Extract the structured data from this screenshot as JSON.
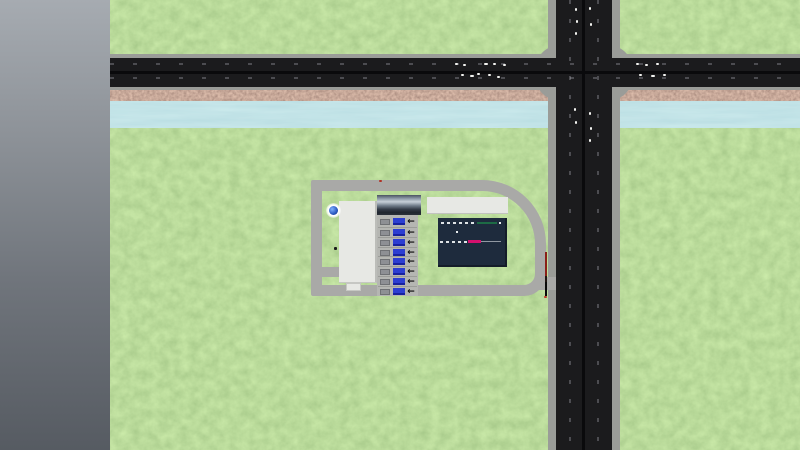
{
  "scene": {
    "description": "top-down transport simulation map view with river, road intersection and truck logistics facility",
    "viewport": {
      "width": 800,
      "height": 450
    },
    "visible_text": "none"
  },
  "colors": {
    "grass_base": "#7cb356",
    "river_blue": "#85c4cd",
    "rock_brown": "#7a4a41",
    "asphalt": "#1b1b1d",
    "road_center": "#0a0a0c",
    "curb": "#9a9c98",
    "complex_road": "#a9a9a7",
    "building_white": "#e7e8e4",
    "dock_concrete": "#b5b6b2",
    "navy_building": "#1e2b3d",
    "truck_blue": "#2c3ed2",
    "bay_box": "#8e9094",
    "marking_green": "#1d6b45",
    "marking_magenta": "#d4106e",
    "pole_red": "#8a2018",
    "vehicle_white": "#f2f3f0"
  },
  "terrain": {
    "void_panel": "out-of-map gray gradient band, left 110px",
    "river": {
      "y": 101,
      "height": 27
    },
    "rock_embankment": {
      "y": 88,
      "height": 15
    }
  },
  "roads": {
    "horizontal_road": {
      "lanes": 2,
      "y": 58,
      "height": 29
    },
    "vertical_road": {
      "lanes": 2,
      "x": 556,
      "width": 56
    },
    "intersection": {
      "x": 536,
      "y": 46,
      "width": 96,
      "height": 54
    }
  },
  "facility": {
    "ring_road": "loop road around industrial plot with large top-right curve",
    "warehouse": "large white building, west side",
    "office": "white strip building, north-east",
    "factory": "dark navy flat roof with white/green/magenta pipe markings",
    "dock": {
      "rows": 8,
      "arrow_icon": "←",
      "truck_color_note": "blue trailers at each bay"
    },
    "fountain": "blue pool with white splash on lawn",
    "barrier_pole": "red/black gate pole at east entrance"
  },
  "vehicles": [
    {
      "name": "vehicle-dot",
      "x": 455,
      "y": 63,
      "w": 3,
      "h": 2,
      "color": "#f2f3f0"
    },
    {
      "name": "vehicle-dot",
      "x": 463,
      "y": 64,
      "w": 3,
      "h": 2,
      "color": "#f2f3f0"
    },
    {
      "name": "vehicle-dot",
      "x": 484,
      "y": 63,
      "w": 4,
      "h": 2,
      "color": "#f2f3f0"
    },
    {
      "name": "vehicle-dot",
      "x": 493,
      "y": 63,
      "w": 3,
      "h": 2,
      "color": "#f2f3f0"
    },
    {
      "name": "vehicle-dot",
      "x": 503,
      "y": 64,
      "w": 3,
      "h": 2,
      "color": "#f2f3f0"
    },
    {
      "name": "vehicle-dot",
      "x": 461,
      "y": 74,
      "w": 3,
      "h": 2,
      "color": "#f2f3f0"
    },
    {
      "name": "vehicle-dot",
      "x": 470,
      "y": 75,
      "w": 4,
      "h": 2,
      "color": "#f2f3f0"
    },
    {
      "name": "vehicle-dot",
      "x": 477,
      "y": 73,
      "w": 3,
      "h": 2,
      "color": "#f2f3f0"
    },
    {
      "name": "vehicle-dot",
      "x": 488,
      "y": 74,
      "w": 3,
      "h": 2,
      "color": "#f2f3f0"
    },
    {
      "name": "vehicle-dot",
      "x": 497,
      "y": 76,
      "w": 3,
      "h": 2,
      "color": "#f2f3f0"
    },
    {
      "name": "vehicle-dot",
      "x": 636,
      "y": 63,
      "w": 3,
      "h": 2,
      "color": "#f2f3f0"
    },
    {
      "name": "vehicle-dot",
      "x": 645,
      "y": 64,
      "w": 3,
      "h": 2,
      "color": "#f2f3f0"
    },
    {
      "name": "vehicle-dot",
      "x": 656,
      "y": 63,
      "w": 3,
      "h": 2,
      "color": "#f2f3f0"
    },
    {
      "name": "vehicle-dot",
      "x": 639,
      "y": 74,
      "w": 3,
      "h": 2,
      "color": "#f2f3f0"
    },
    {
      "name": "vehicle-dot",
      "x": 651,
      "y": 75,
      "w": 4,
      "h": 2,
      "color": "#f2f3f0"
    },
    {
      "name": "vehicle-dot",
      "x": 663,
      "y": 74,
      "w": 3,
      "h": 2,
      "color": "#f2f3f0"
    },
    {
      "name": "vehicle-dot",
      "x": 575,
      "y": 8,
      "w": 2,
      "h": 3,
      "color": "#f2f3f0"
    },
    {
      "name": "vehicle-dot",
      "x": 576,
      "y": 20,
      "w": 2,
      "h": 3,
      "color": "#f2f3f0"
    },
    {
      "name": "vehicle-dot",
      "x": 575,
      "y": 32,
      "w": 2,
      "h": 3,
      "color": "#f2f3f0"
    },
    {
      "name": "vehicle-dot",
      "x": 589,
      "y": 7,
      "w": 2,
      "h": 3,
      "color": "#f2f3f0"
    },
    {
      "name": "vehicle-dot",
      "x": 590,
      "y": 23,
      "w": 2,
      "h": 3,
      "color": "#f2f3f0"
    },
    {
      "name": "vehicle-dot",
      "x": 574,
      "y": 108,
      "w": 2,
      "h": 3,
      "color": "#f2f3f0"
    },
    {
      "name": "vehicle-dot",
      "x": 575,
      "y": 121,
      "w": 2,
      "h": 3,
      "color": "#f2f3f0"
    },
    {
      "name": "vehicle-dot",
      "x": 589,
      "y": 112,
      "w": 2,
      "h": 3,
      "color": "#f2f3f0"
    },
    {
      "name": "vehicle-dot",
      "x": 590,
      "y": 127,
      "w": 2,
      "h": 3,
      "color": "#f2f3f0"
    },
    {
      "name": "vehicle-dot",
      "x": 589,
      "y": 139,
      "w": 2,
      "h": 3,
      "color": "#f2f3f0"
    },
    {
      "name": "marker-dot",
      "x": 379,
      "y": 180,
      "w": 3,
      "h": 2,
      "color": "#b03226"
    },
    {
      "name": "marker-dot",
      "x": 544,
      "y": 296,
      "w": 3,
      "h": 2,
      "color": "#c03a2a"
    }
  ]
}
